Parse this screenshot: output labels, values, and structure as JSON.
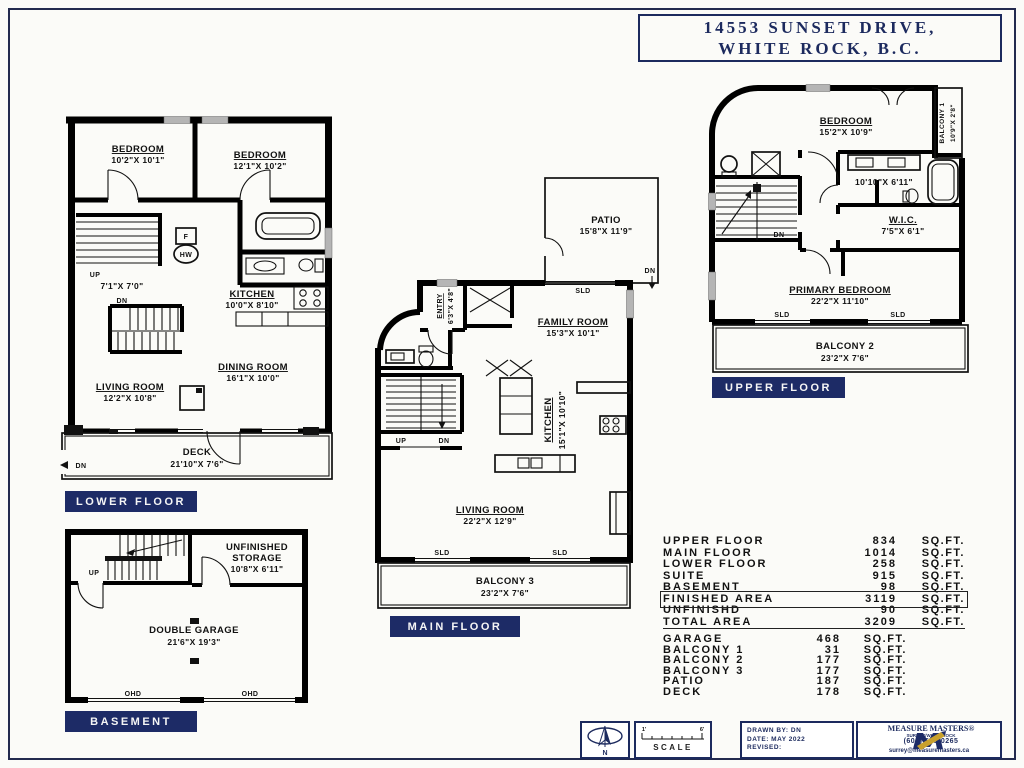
{
  "title": {
    "line1": "14553 SUNSET DRIVE,",
    "line2": "WHITE ROCK, B.C."
  },
  "floors": {
    "lower": {
      "tag": "LOWER FLOOR",
      "bed1_name": "BEDROOM",
      "bed1_dims": "10'2\"X 10'1\"",
      "bed2_name": "BEDROOM",
      "bed2_dims": "12'1\"X 10'2\"",
      "hall_dims": "7'1\"X 7'0\"",
      "up": "UP",
      "dn": "DN",
      "furnace": "F",
      "hw": "HW",
      "kitchen_name": "KITCHEN",
      "kitchen_dims": "10'0\"X 8'10\"",
      "dining_name": "DINING ROOM",
      "dining_dims": "16'1\"X 10'0\"",
      "living_name": "LIVING ROOM",
      "living_dims": "12'2\"X 10'8\"",
      "deck_name": "DECK",
      "deck_dims": "21'10\"X 7'6\"",
      "deck_dn": "DN"
    },
    "basement": {
      "tag": "BASEMENT",
      "up": "UP",
      "storage1": "UNFINISHED",
      "storage2": "STORAGE",
      "storage_dims": "10'8\"X 6'11\"",
      "garage_name": "DOUBLE GARAGE",
      "garage_dims": "21'6\"X 19'3\"",
      "ohd": "OHD"
    },
    "main": {
      "tag": "MAIN FLOOR",
      "patio_name": "PATIO",
      "patio_dims": "15'8\"X 11'9\"",
      "patio_dn": "DN",
      "entry_name": "ENTRY",
      "entry_dims": "6'3\"X 4'8\"",
      "family_name": "FAMILY ROOM",
      "family_dims": "15'3\"X 10'1\"",
      "kitchen_name": "KITCHEN",
      "kitchen_dims": "15'1\"X 10'10\"",
      "living_name": "LIVING ROOM",
      "living_dims": "22'2\"X 12'9\"",
      "balcony_name": "BALCONY 3",
      "balcony_dims": "23'2\"X 7'6\"",
      "sld": "SLD",
      "up": "UP",
      "dn": "DN"
    },
    "upper": {
      "tag": "UPPER FLOOR",
      "bedroom_name": "BEDROOM",
      "bedroom_dims": "15'2\"X 10'9\"",
      "balcony1_name": "BALCONY 1",
      "balcony1_dims": "10'9\"X 2'8\"",
      "bath_dims": "10'10\"X 6'11\"",
      "wic_name": "W.I.C.",
      "wic_dims": "7'5\"X 6'1\"",
      "primary_name": "PRIMARY BEDROOM",
      "primary_dims": "22'2\"X 11'10\"",
      "balcony2_name": "BALCONY 2",
      "balcony2_dims": "23'2\"X 7'6\"",
      "sld": "SLD",
      "dn": "DN"
    }
  },
  "areas": {
    "unit": "SQ.FT.",
    "main_rows": [
      {
        "name": "UPPER FLOOR",
        "value": "834"
      },
      {
        "name": "MAIN FLOOR",
        "value": "1014"
      },
      {
        "name": "LOWER FLOOR",
        "value": "258"
      },
      {
        "name": "SUITE",
        "value": "915"
      },
      {
        "name": "BASEMENT",
        "value": "98"
      },
      {
        "name": "FINISHED AREA",
        "value": "3119"
      },
      {
        "name": "UNFINISHD",
        "value": "90"
      },
      {
        "name": "TOTAL AREA",
        "value": "3209"
      }
    ],
    "extra_rows": [
      {
        "name": "GARAGE",
        "value": "468"
      },
      {
        "name": "BALCONY 1",
        "value": "31"
      },
      {
        "name": "BALCONY 2",
        "value": "177"
      },
      {
        "name": "BALCONY 3",
        "value": "177"
      },
      {
        "name": "PATIO",
        "value": "187"
      },
      {
        "name": "DECK",
        "value": "178"
      }
    ]
  },
  "footer": {
    "north": "N",
    "scale_label": "SCALE",
    "scale_left": "1'",
    "scale_right": "6'",
    "drawn_by": "DRAWN BY: DN",
    "date": "DATE: MAY 2022",
    "revised": "REVISED:",
    "brand": "MEASURE MASTERS®",
    "brand_sub": "SURREY/WHITE ROCK",
    "brand_phone": "(604) 539-0265",
    "brand_email": "surrey@measuremasters.ca"
  },
  "colors": {
    "navy": "#1d2b66",
    "wall": "#000000",
    "window": "#b5b5b5",
    "gold": "#c8a02c"
  }
}
